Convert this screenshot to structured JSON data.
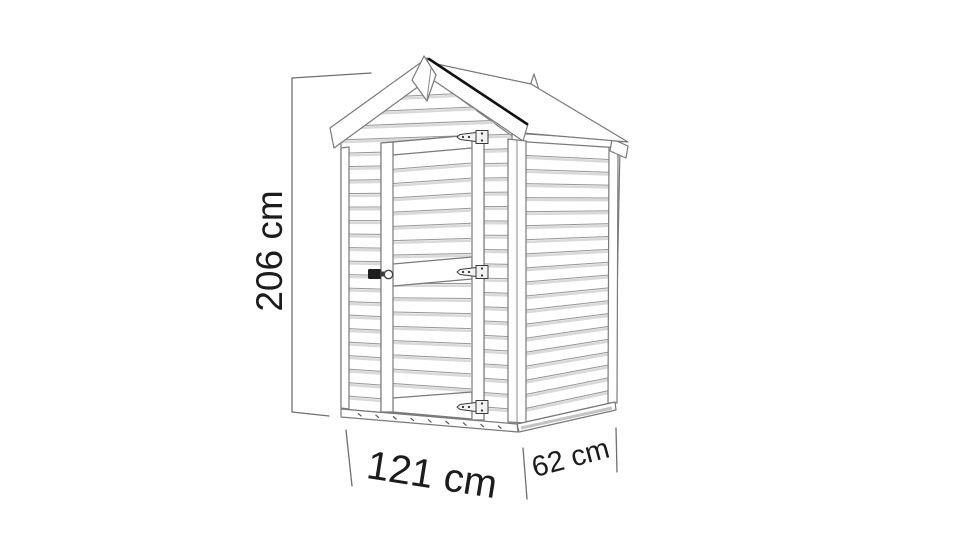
{
  "diagram": {
    "subject": "apex garden shed dimension drawing",
    "dimensions": {
      "height": {
        "label": "206 cm",
        "value": 206,
        "unit": "cm",
        "orientation": "vertical"
      },
      "width": {
        "label": "121 cm",
        "value": 121,
        "unit": "cm",
        "orientation": "front"
      },
      "depth": {
        "label": "62 cm",
        "value": 62,
        "unit": "cm",
        "orientation": "side"
      }
    },
    "colors": {
      "background": "#ffffff",
      "line": "#7a7a7a",
      "accent_dark": "#111111",
      "plank_shading": "#d9d9d9",
      "text": "#1c1c1c"
    }
  }
}
